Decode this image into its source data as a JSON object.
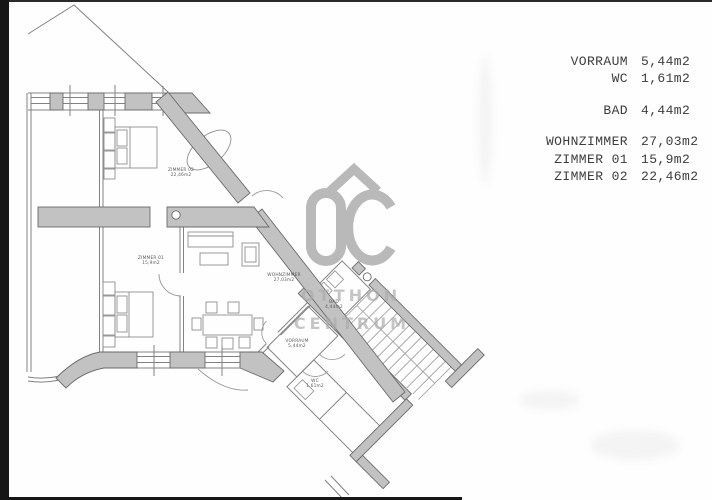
{
  "legend": {
    "groups": [
      [
        {
          "name": "VORRAUM",
          "value": "5,44m2"
        },
        {
          "name": "WC",
          "value": "1,61m2"
        }
      ],
      [
        {
          "name": "BAD",
          "value": "4,44m2"
        }
      ],
      [
        {
          "name": "WOHNZIMMER",
          "value": "27,03m2"
        },
        {
          "name": "ZIMMER 01",
          "value": "15,9m2"
        },
        {
          "name": "ZIMMER 02",
          "value": "22,46m2"
        }
      ]
    ]
  },
  "watermark": {
    "logo_text": "OC",
    "line1": "OTTHON",
    "line2": "CENTRUM"
  },
  "plan": {
    "room_labels": [
      {
        "id": "zimmer-02",
        "x": 181,
        "y": 171,
        "line1": "ZIMMER 02",
        "line2": "22,46m2"
      },
      {
        "id": "zimmer-01",
        "x": 151,
        "y": 259,
        "line1": "ZIMMER 01",
        "line2": "15,9m2"
      },
      {
        "id": "wohnzimmer",
        "x": 284,
        "y": 276,
        "line1": "WOHNZIMMER",
        "line2": "27,03m2"
      },
      {
        "id": "vorraum",
        "x": 297,
        "y": 342,
        "line1": "VORRAUM",
        "line2": "5,44m2"
      },
      {
        "id": "bad",
        "x": 334,
        "y": 303,
        "line1": "BAD",
        "line2": "4,44m2"
      },
      {
        "id": "wc",
        "x": 315,
        "y": 382,
        "line1": "WC",
        "line2": "1,61m2"
      }
    ]
  },
  "colors": {
    "wall_fill": "#c2c2c2",
    "wall_stroke": "#6b6b6b",
    "thin_line": "#828282",
    "furniture_line": "#8f8f8f",
    "watermark_gray": "#a9a9a9",
    "legend_text": "#3d3d3d",
    "scan_edge": "#161616"
  }
}
